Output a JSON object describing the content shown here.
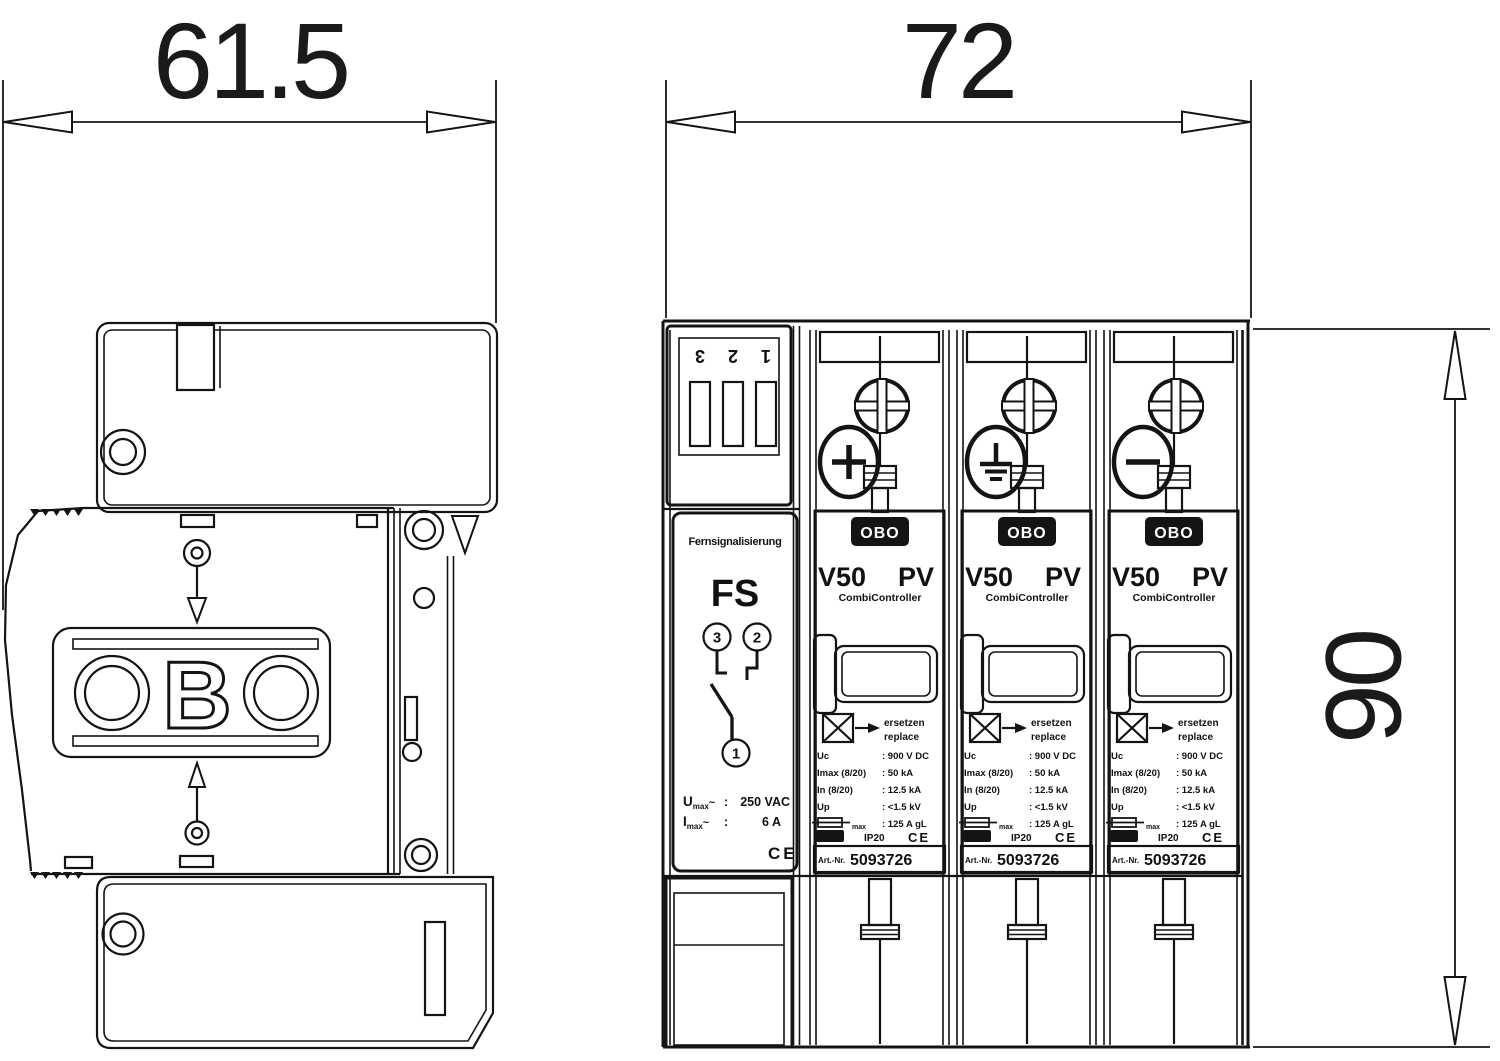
{
  "dims": {
    "side_width": "61.5",
    "front_width": "72",
    "front_height": "90"
  },
  "side_view": {
    "logo": "OBO",
    "logo_letter": "B"
  },
  "front_view": {
    "fs": {
      "terminal_numbers": [
        "1",
        "2",
        "3"
      ],
      "title": "Fernsignalisierung",
      "abbr": "FS",
      "contacts": [
        "3",
        "2",
        "1"
      ],
      "u_sym": "U",
      "u_sub": "max",
      "u_tilde": "~",
      "u_colon": ":",
      "u_value": "250 VAC",
      "i_sym": "I",
      "i_sub": "max",
      "i_tilde": "~",
      "i_colon": ":",
      "i_value": "6 A",
      "ce": "CE"
    },
    "v50_modules": [
      {
        "polarity": "plus",
        "logo": "OBO",
        "title_v": "V50",
        "title_pv": "PV",
        "subtitle": "CombiController",
        "replace_de": "ersetzen",
        "replace_en": "replace",
        "specs": [
          {
            "label": "Uc",
            "value": ": 900 V DC"
          },
          {
            "label": "Imax (8/20)",
            "value": ": 50 kA"
          },
          {
            "label": "In (8/20)",
            "value": ": 12.5 kA"
          },
          {
            "label": "Up",
            "value": ": <1.5 kV"
          },
          {
            "label": "max",
            "value": ": 125 A gL"
          }
        ],
        "ip": "IP20",
        "ce": "CE",
        "art_label": "Art.-Nr.",
        "art_no": "5093726"
      },
      {
        "polarity": "earth",
        "logo": "OBO",
        "title_v": "V50",
        "title_pv": "PV",
        "subtitle": "CombiController",
        "replace_de": "ersetzen",
        "replace_en": "replace",
        "specs": [
          {
            "label": "Uc",
            "value": ": 900 V DC"
          },
          {
            "label": "Imax (8/20)",
            "value": ": 50 kA"
          },
          {
            "label": "In (8/20)",
            "value": ": 12.5 kA"
          },
          {
            "label": "Up",
            "value": ": <1.5 kV"
          },
          {
            "label": "max",
            "value": ": 125 A gL"
          }
        ],
        "ip": "IP20",
        "ce": "CE",
        "art_label": "Art.-Nr.",
        "art_no": "5093726"
      },
      {
        "polarity": "minus",
        "logo": "OBO",
        "title_v": "V50",
        "title_pv": "PV",
        "subtitle": "CombiController",
        "replace_de": "ersetzen",
        "replace_en": "replace",
        "specs": [
          {
            "label": "Uc",
            "value": ": 900 V DC"
          },
          {
            "label": "Imax (8/20)",
            "value": ": 50 kA"
          },
          {
            "label": "In (8/20)",
            "value": ": 12.5 kA"
          },
          {
            "label": "Up",
            "value": ": <1.5 kV"
          },
          {
            "label": "max",
            "value": ": 125 A gL"
          }
        ],
        "ip": "IP20",
        "ce": "CE",
        "art_label": "Art.-Nr.",
        "art_no": "5093726"
      }
    ]
  }
}
